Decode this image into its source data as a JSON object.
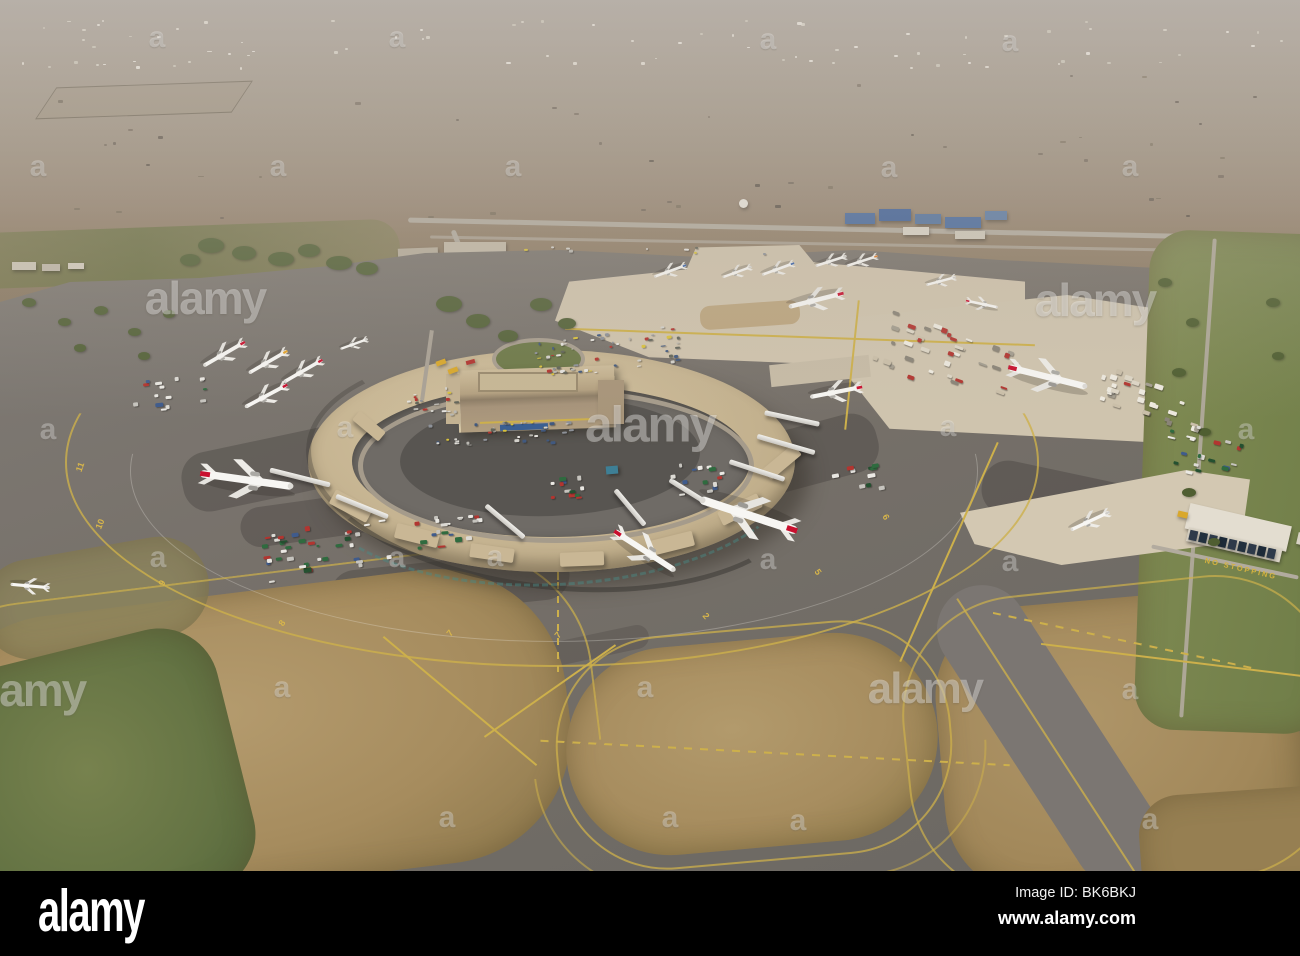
{
  "footer": {
    "logo": "alamy",
    "image_id": "Image ID: BK6BKJ",
    "url": "www.alamy.com"
  },
  "colors": {
    "kq_red": "#c8102e",
    "yellow_marking": "#cdb04b",
    "asphalt": "#75716c",
    "concrete_apron": "#cfc3ad",
    "terminal_roof": "#c4b292",
    "grass_brown": "#a78d5f",
    "grass_green": "#6f7b4a",
    "haze": "#a79e97",
    "footer_bg": "#000000"
  },
  "watermarks": {
    "logo_text": "alamy",
    "letter": "a",
    "logos": [
      [
        205,
        298,
        1
      ],
      [
        1095,
        300,
        1
      ],
      [
        650,
        424,
        1.08
      ],
      [
        925,
        688,
        0.95
      ],
      [
        25,
        690,
        1
      ]
    ],
    "letters": [
      [
        157,
        38
      ],
      [
        397,
        38
      ],
      [
        768,
        40
      ],
      [
        1010,
        42
      ],
      [
        38,
        167
      ],
      [
        278,
        167
      ],
      [
        513,
        167
      ],
      [
        889,
        168
      ],
      [
        1130,
        167
      ],
      [
        48,
        430
      ],
      [
        345,
        428
      ],
      [
        948,
        427
      ],
      [
        1246,
        430
      ],
      [
        158,
        558
      ],
      [
        397,
        558
      ],
      [
        495,
        557
      ],
      [
        768,
        560
      ],
      [
        1010,
        562
      ],
      [
        282,
        688
      ],
      [
        645,
        688
      ],
      [
        1130,
        690
      ],
      [
        447,
        818
      ],
      [
        670,
        818
      ],
      [
        798,
        821
      ],
      [
        1150,
        820
      ]
    ]
  },
  "markings": {
    "stand_numbers": [
      {
        "label": "11",
        "x": 80,
        "y": 467,
        "r": -70
      },
      {
        "label": "10",
        "x": 100,
        "y": 524,
        "r": -68
      },
      {
        "label": "9",
        "x": 162,
        "y": 583,
        "r": -62
      },
      {
        "label": "8",
        "x": 282,
        "y": 623,
        "r": -55
      },
      {
        "label": "7",
        "x": 450,
        "y": 633,
        "r": -50
      },
      {
        "label": "7",
        "x": 558,
        "y": 635,
        "r": -48
      },
      {
        "label": "5",
        "x": 818,
        "y": 572,
        "r": 55
      },
      {
        "label": "6",
        "x": 886,
        "y": 517,
        "r": 60
      },
      {
        "label": "2",
        "x": 706,
        "y": 616,
        "r": 50
      }
    ],
    "road_text": {
      "label": "NO STOPPING",
      "x": 1204,
      "y": 564,
      "r": 13
    }
  },
  "aircraft": [
    {
      "x": 224,
      "y": 354,
      "r": 150,
      "s": 0.56,
      "t": "kq"
    },
    {
      "x": 268,
      "y": 362,
      "r": 150,
      "s": 0.52,
      "t": "yellow"
    },
    {
      "x": 303,
      "y": 371,
      "r": 150,
      "s": 0.52,
      "t": "kq"
    },
    {
      "x": 354,
      "y": 344,
      "r": 160,
      "s": 0.34,
      "t": "plain"
    },
    {
      "x": 266,
      "y": 396,
      "r": 152,
      "s": 0.56,
      "t": "kq"
    },
    {
      "x": 247,
      "y": 480,
      "r": 8,
      "s": 1.1,
      "t": "kq"
    },
    {
      "x": 30,
      "y": 586,
      "r": 185,
      "s": 0.46,
      "t": "plain"
    },
    {
      "x": 670,
      "y": 271,
      "r": 160,
      "s": 0.4,
      "t": "blue"
    },
    {
      "x": 737,
      "y": 272,
      "r": 160,
      "s": 0.36,
      "t": "plain"
    },
    {
      "x": 778,
      "y": 269,
      "r": 160,
      "s": 0.4,
      "t": "blue"
    },
    {
      "x": 831,
      "y": 261,
      "r": 162,
      "s": 0.38,
      "t": "plain"
    },
    {
      "x": 862,
      "y": 261,
      "r": 162,
      "s": 0.38,
      "t": "orange"
    },
    {
      "x": 941,
      "y": 281,
      "r": 165,
      "s": 0.36,
      "t": "plain"
    },
    {
      "x": 982,
      "y": 304,
      "r": 12,
      "s": 0.38,
      "t": "kq"
    },
    {
      "x": 816,
      "y": 300,
      "r": 166,
      "s": 0.66,
      "t": "kq"
    },
    {
      "x": 1048,
      "y": 377,
      "r": 14,
      "s": 0.95,
      "t": "kq"
    },
    {
      "x": 836,
      "y": 392,
      "r": 169,
      "s": 0.62,
      "t": "kq"
    },
    {
      "x": 748,
      "y": 515,
      "r": 198,
      "s": 1.2,
      "t": "kq"
    },
    {
      "x": 645,
      "y": 551,
      "r": 33,
      "s": 0.85,
      "t": "kq"
    },
    {
      "x": 1090,
      "y": 521,
      "r": 155,
      "s": 0.5,
      "t": "plain"
    }
  ],
  "jet_bridges": [
    {
      "x": 300,
      "y": 477,
      "l": 62,
      "r": 14
    },
    {
      "x": 362,
      "y": 506,
      "l": 56,
      "r": 22
    },
    {
      "x": 505,
      "y": 521,
      "l": 50,
      "r": 40
    },
    {
      "x": 630,
      "y": 507,
      "l": 46,
      "r": 50
    },
    {
      "x": 690,
      "y": 492,
      "l": 48,
      "r": 32
    },
    {
      "x": 757,
      "y": 470,
      "l": 58,
      "r": 18
    },
    {
      "x": 786,
      "y": 444,
      "l": 60,
      "r": 16
    },
    {
      "x": 792,
      "y": 418,
      "l": 56,
      "r": 12
    }
  ],
  "vehicle_clusters": [
    {
      "x": 650,
      "y": 45,
      "w": 1280,
      "h": 52,
      "n": 80,
      "pal": "speck",
      "r": 0,
      "layer": "far"
    },
    {
      "x": 640,
      "y": 150,
      "w": 1260,
      "h": 150,
      "n": 45,
      "pal": "dark",
      "r": 0,
      "layer": "far"
    },
    {
      "x": 610,
      "y": 352,
      "w": 150,
      "h": 40,
      "n": 58,
      "pal": "cars",
      "r": -7,
      "layer": "near"
    },
    {
      "x": 432,
      "y": 402,
      "w": 58,
      "h": 30,
      "n": 18,
      "pal": "cars",
      "r": -4,
      "layer": "near"
    },
    {
      "x": 500,
      "y": 434,
      "w": 150,
      "h": 26,
      "n": 38,
      "pal": "cars",
      "r": -3,
      "layer": "near"
    },
    {
      "x": 648,
      "y": 250,
      "w": 250,
      "h": 8,
      "n": 9,
      "pal": "cars",
      "r": 1,
      "layer": "near"
    },
    {
      "x": 325,
      "y": 550,
      "w": 130,
      "h": 52,
      "n": 38,
      "pal": "gear",
      "r": -8,
      "layer": "near"
    },
    {
      "x": 448,
      "y": 528,
      "w": 70,
      "h": 40,
      "n": 20,
      "pal": "gear",
      "r": -5,
      "layer": "near"
    },
    {
      "x": 575,
      "y": 487,
      "w": 56,
      "h": 28,
      "n": 12,
      "pal": "gear",
      "r": -5,
      "layer": "near"
    },
    {
      "x": 700,
      "y": 478,
      "w": 66,
      "h": 34,
      "n": 14,
      "pal": "gear",
      "r": -8,
      "layer": "near"
    },
    {
      "x": 168,
      "y": 392,
      "w": 86,
      "h": 38,
      "n": 15,
      "pal": "gear",
      "r": -6,
      "layer": "near"
    },
    {
      "x": 950,
      "y": 362,
      "w": 150,
      "h": 66,
      "n": 38,
      "pal": "cargo",
      "r": 20,
      "layer": "near"
    },
    {
      "x": 1152,
      "y": 400,
      "w": 112,
      "h": 40,
      "n": 28,
      "pal": "cargo",
      "r": 18,
      "layer": "near"
    },
    {
      "x": 1204,
      "y": 452,
      "w": 86,
      "h": 52,
      "n": 22,
      "pal": "gear",
      "r": 14,
      "layer": "near"
    },
    {
      "x": 858,
      "y": 480,
      "w": 60,
      "h": 30,
      "n": 10,
      "pal": "gear",
      "r": -10,
      "layer": "near"
    }
  ]
}
